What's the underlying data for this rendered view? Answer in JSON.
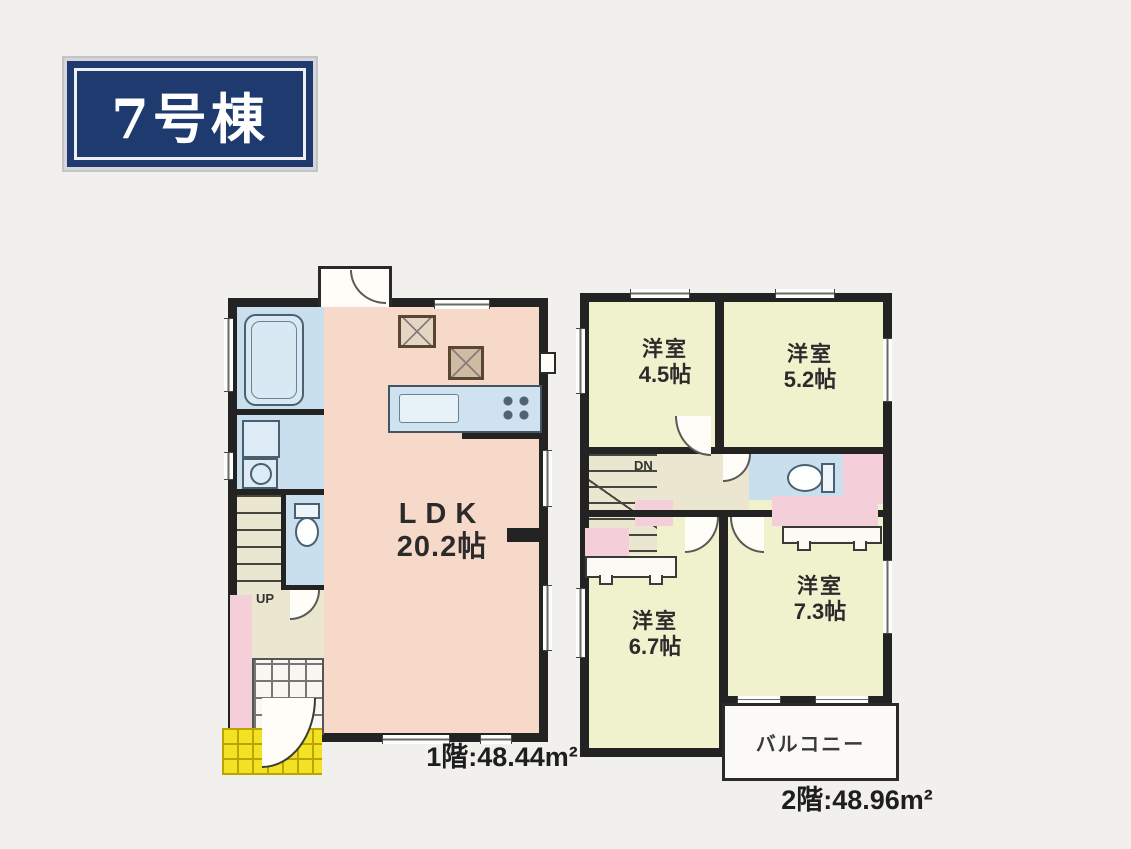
{
  "building_label": "7号棟",
  "floor1": {
    "area_label": "1階:48.44m²",
    "ldk_name": "LDK",
    "ldk_size": "20.2帖",
    "stairs_label": "UP"
  },
  "floor2": {
    "area_label": "2階:48.96m²",
    "rooms": [
      {
        "name": "洋室",
        "size": "4.5帖"
      },
      {
        "name": "洋室",
        "size": "5.2帖"
      },
      {
        "name": "洋室",
        "size": "6.7帖"
      },
      {
        "name": "洋室",
        "size": "7.3帖"
      }
    ],
    "stairs_label": "DN",
    "balcony_label": "バルコニー"
  },
  "colors": {
    "wall": "#232323",
    "ldk_fill": "#f6d9c8",
    "wet_area_fill": "#c9dfee",
    "bedroom_fill": "#eff2cd",
    "closet_fill": "#f4cfda",
    "hall_fill": "#eae6cf",
    "porch_fill": "#f1e224",
    "label_navy": "#1e3a6e",
    "page_background": "#f2f0ec"
  }
}
